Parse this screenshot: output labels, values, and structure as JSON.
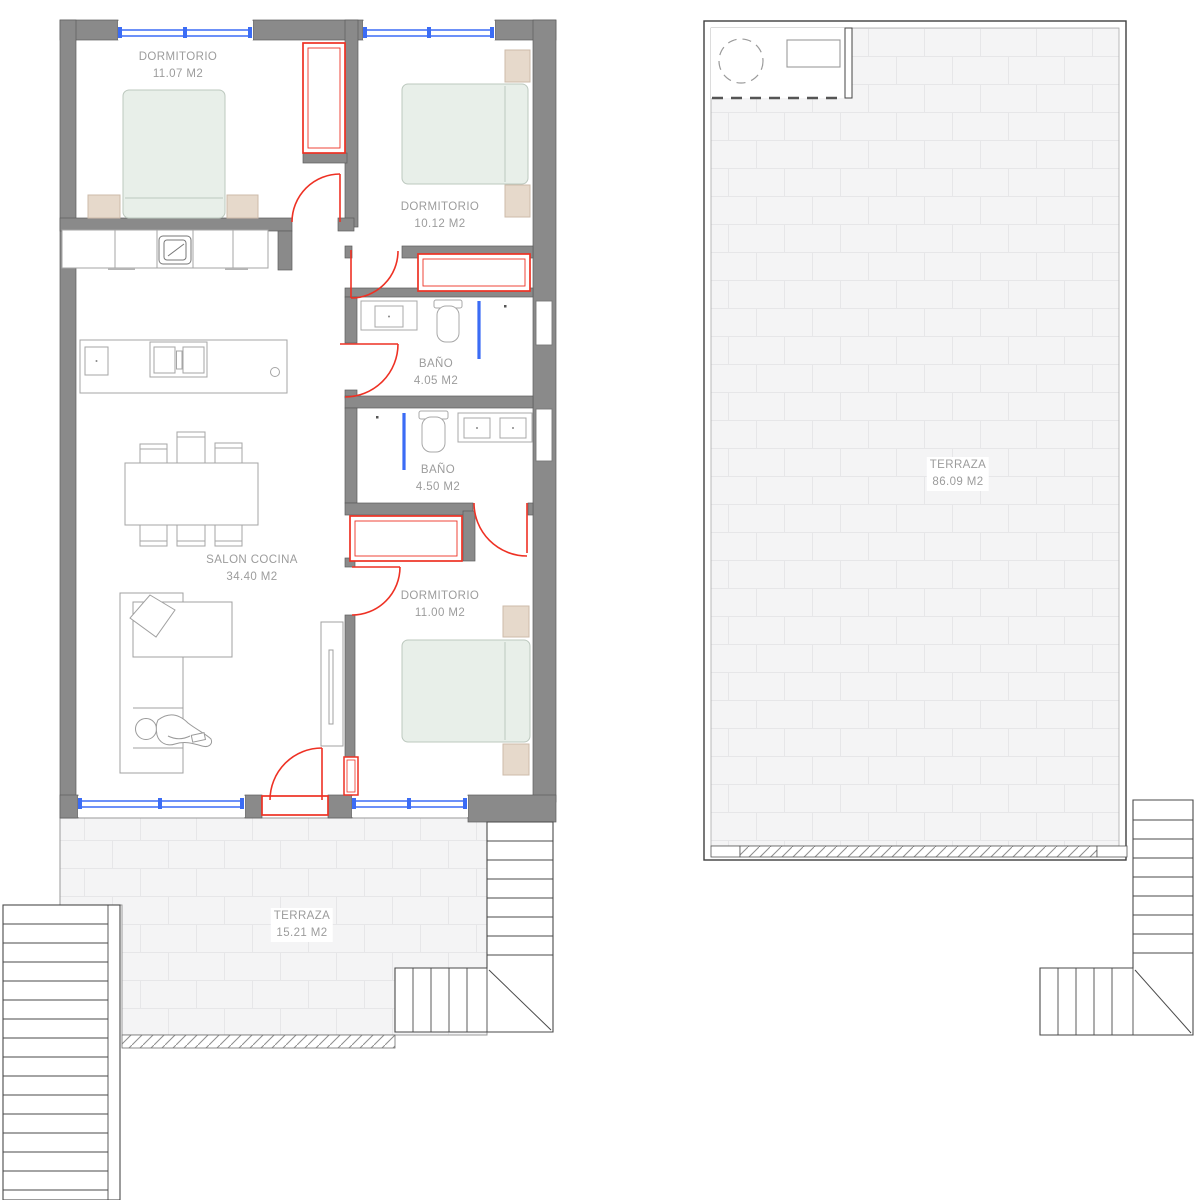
{
  "plan": {
    "title": "apartment-floor-plan",
    "rooms": [
      {
        "name": "DORMITORIO",
        "area": "11.07 M2"
      },
      {
        "name": "DORMITORIO",
        "area": "10.12 M2"
      },
      {
        "name": "BAÑO",
        "area": "4.05 M2"
      },
      {
        "name": "BAÑO",
        "area": "4.50 M2"
      },
      {
        "name": "SALON COCINA",
        "area": "34.40 M2"
      },
      {
        "name": "DORMITORIO",
        "area": "11.00 M2"
      },
      {
        "name": "TERRAZA",
        "area": "15.21 M2"
      },
      {
        "name": "TERRAZA",
        "area": "86.09 M2"
      }
    ],
    "colors": {
      "wall": "#8a8a8a",
      "wall_edge": "#5c5c5c",
      "door_red": "#ee3124",
      "window_blue": "#3b6cf5",
      "bed_fill": "#e8efe9",
      "wood_fill": "#e6d9cb",
      "tile_fill": "#f4f4f5",
      "tile_line": "#e6e6e8",
      "label_text": "#9c9c9c"
    },
    "icons": [
      "double-bed-icon",
      "nightstand-icon",
      "wardrobe-icon",
      "door-swing-icon",
      "window-icon",
      "kitchen-counter-icon",
      "hob-icon",
      "kitchen-island-icon",
      "dining-table-icon",
      "chair-icon",
      "sofa-icon",
      "person-icon",
      "tv-unit-icon",
      "toilet-icon",
      "sink-icon",
      "shower-screen-icon",
      "stairs-icon",
      "water-heater-icon",
      "hatch-threshold-icon"
    ]
  }
}
